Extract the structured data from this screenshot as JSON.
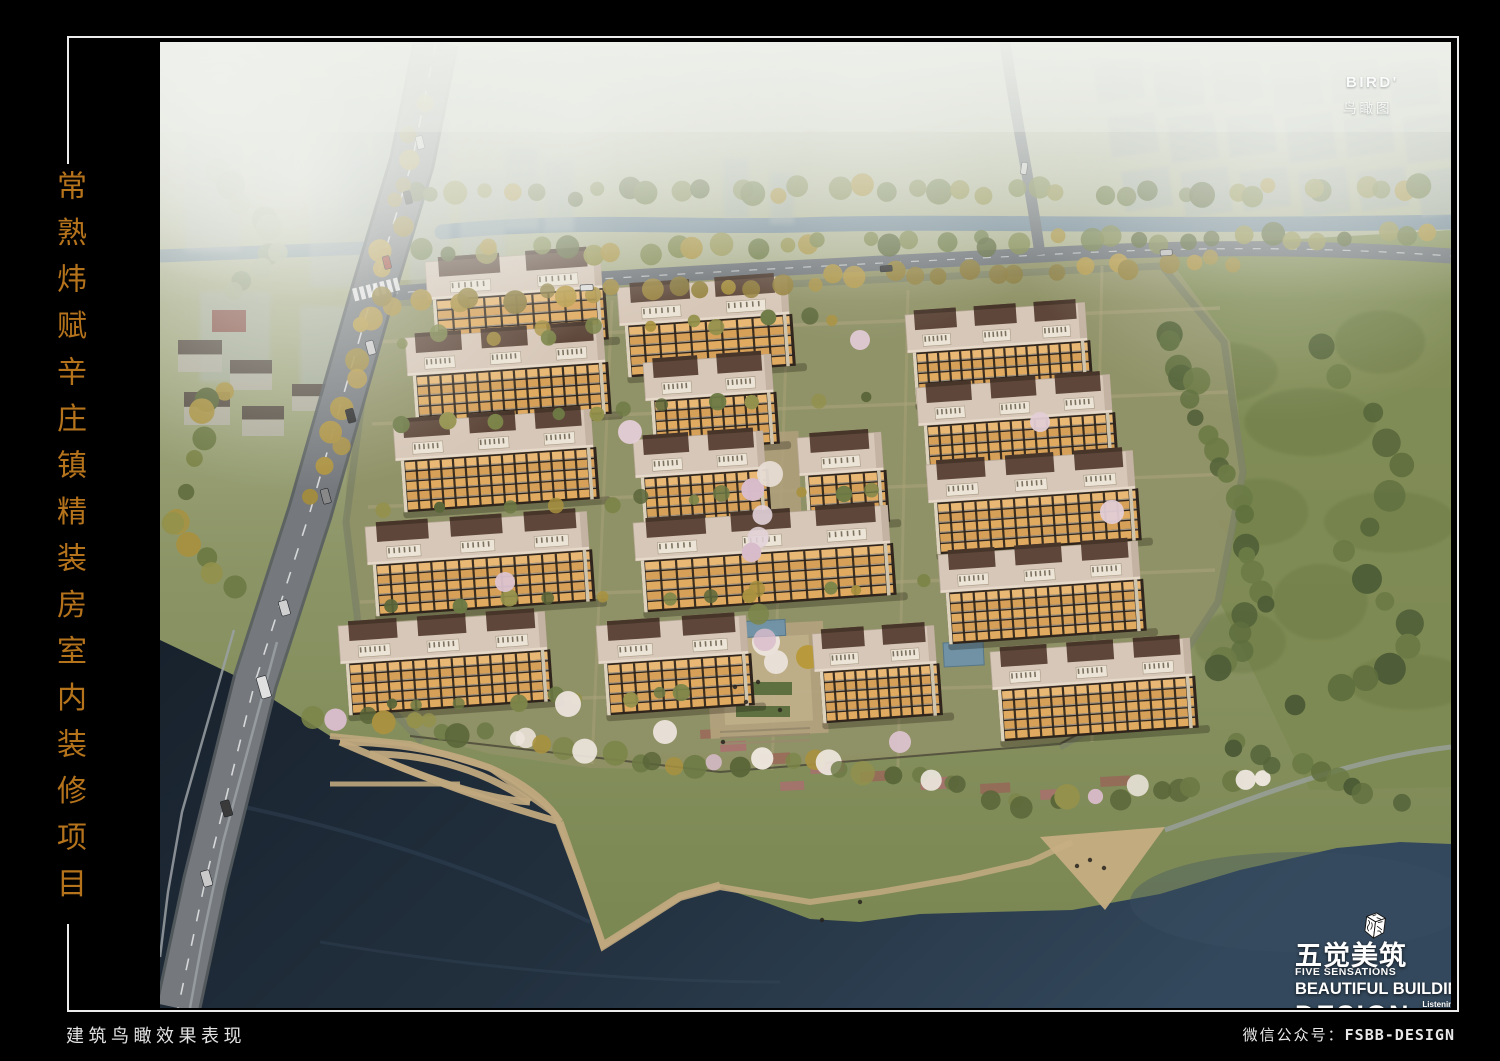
{
  "side_title": {
    "text": "常熟炜赋辛庄镇精装房室内装修项目",
    "color": "#b5731c"
  },
  "artwork": {
    "bird_label": "BIRD'",
    "bird_sublabel": "鸟瞰图"
  },
  "logo": {
    "cn_name": "五觉美筑",
    "en_name": "FIVE SENSATIONS",
    "line1": "BEAUTIFUL BUILDING",
    "line2": "DESIGN",
    "tags": [
      "Listening\\Smelling",
      "Visioning\\Touching",
      "Tasting\\Performance"
    ]
  },
  "footer": {
    "left_caption": "建筑鸟瞰效果表现",
    "right_label": "微信公众号：",
    "right_code": "FSBB-DESIGN"
  },
  "scene": {
    "w": 1291,
    "h": 966,
    "colors": {
      "field": "#7d8a52",
      "compound": "#8f9166",
      "canal": "#6f8699",
      "road_major": "#75797d",
      "road_minor": "#6d7277",
      "path": "#c0a87e",
      "plaza": "#c7ad83",
      "roof": "#d7c7b8",
      "ridge": "#5e473a",
      "roofbox": "#ece4d6",
      "facade_dark": "#2f251c"
    },
    "palettes": {
      "mix": [
        "#6d7a45",
        "#7c8549",
        "#93914c",
        "#a8913f",
        "#5a6639"
      ],
      "gold": [
        "#ab9140",
        "#b89a45",
        "#93803a",
        "#a38c3e",
        "#8a7a3c"
      ],
      "green": [
        "#5f6f3e",
        "#55643a",
        "#6c7b46",
        "#4d5c36"
      ],
      "shore": [
        "#6d7a45",
        "#7c8549",
        "#a8913f",
        "#5a6639",
        "#93914c",
        "#6d7a45",
        "#d9bccb",
        "#ece5dc"
      ],
      "pinkmix": [
        "#d9bccb",
        "#e3d3da",
        "#a8913f",
        "#7c8549"
      ],
      "fade": [
        "#8f9a78",
        "#9aa382",
        "#a5ad8c"
      ]
    },
    "paths": {
      "field": "M 1000,205 L 1291,188 L 1291,745 L 1150,748 L 1060,560 L 1085,430 L 1070,300 Z",
      "compound": "M 200,240 L 1000,205 L 1070,300 L 1085,430 L 1060,560 L 1000,648 L 900,700 L 720,718 L 560,728 L 430,726 L 330,712 L 250,690 L 205,640 L 185,480 L 190,350 Z",
      "inner_ring": "M 215,262 L 1002,224 L 1064,300 L 1083,430 L 1058,560 L 1002,646 L 900,705 M 215,262 L 186,480 L 205,640 L 262,700",
      "row_paths": [
        "M 215,300 L 1060,266",
        "M 212,382 L 1068,350",
        "M 208,465 L 1070,432",
        "M 200,560 L 1055,528",
        "M 205,662 L 1000,640"
      ],
      "col_paths": [
        "M 452,258 L 432,722",
        "M 628,252 L 612,728",
        "M 748,248 L 738,725",
        "M 942,224 L 932,700"
      ],
      "canal": "M 282,190 C 420,176 520,186 640,183 C 800,178 980,186 1291,180",
      "canal_left": "M 0,214 L 206,206",
      "north_road": "M 212,253 C 420,236 700,222 880,213 C 1050,203 1180,206 1291,214",
      "east_road": "M 845,0 C 856,80 872,150 880,213",
      "west_road": "M 276,0 L 252,120 L 212,253 L 150,470 L 95,640 L 45,840 L 18,966",
      "bridge_edge1": "M 117,600 L 63,800 L 42,900 L 30,966",
      "bridge_edge2": "M 74,588 L 22,770 L 8,850 L 0,915",
      "water": "M 0,598 L 80,636 L 170,694 L 250,702 L 330,726 L 395,772 L 428,860 L 443,905 L 470,888 L 520,856 L 560,845 L 610,862 L 650,877 L 700,880 L 760,872 L 830,870 L 912,868 L 1000,852 L 1080,828 L 1177,806 L 1240,800 L 1291,802 L 1291,966 L 0,966 Z",
      "shoreline": "M 170,694 L 250,702 L 330,726 L 395,772 L 428,860 L 443,905 L 470,888 L 520,856 L 560,845 L 650,860 L 720,850 L 800,836 L 870,820 L 912,800",
      "leaf1a": "M 180,700 Q 260,700 330,726 Q 380,748 400,780",
      "leaf1b": "M 180,700 Q 300,752 400,780",
      "leaf2a": "M 210,712 Q 300,712 370,760",
      "leaf2b": "M 210,712 Q 310,756 370,760",
      "pier": "M 170,742 L 300,742",
      "walk": "M 400,780 L 428,860 L 443,903 L 470,886 L 520,854 L 560,843",
      "plaza_tri": "M 880,795 L 1005,785 L 945,868 Z",
      "right_path": "M 1005,788 C 1080,762 1180,718 1291,705",
      "fence": "M 250,694 L 560,730 L 900,702 L 1000,648",
      "water_hl1": "M 60,760 Q 260,800 430,880",
      "water_hl2": "M 160,900 Q 400,940 620,940"
    },
    "buildings": [
      {
        "x": 265,
        "y": 220,
        "w": 175,
        "u": 2
      },
      {
        "x": 245,
        "y": 296,
        "w": 198,
        "u": 3
      },
      {
        "x": 233,
        "y": 381,
        "w": 198,
        "u": 3
      },
      {
        "x": 205,
        "y": 485,
        "w": 222,
        "u": 3
      },
      {
        "x": 178,
        "y": 584,
        "w": 207,
        "u": 3
      },
      {
        "x": 457,
        "y": 246,
        "w": 170,
        "u": 2
      },
      {
        "x": 483,
        "y": 321,
        "w": 128,
        "u": 2
      },
      {
        "x": 473,
        "y": 398,
        "w": 130,
        "u": 2
      },
      {
        "x": 637,
        "y": 396,
        "w": 84,
        "u": 1
      },
      {
        "x": 473,
        "y": 481,
        "w": 255,
        "u": 3
      },
      {
        "x": 436,
        "y": 584,
        "w": 150,
        "u": 2
      },
      {
        "x": 652,
        "y": 592,
        "w": 122,
        "u": 2
      },
      {
        "x": 745,
        "y": 273,
        "w": 180,
        "u": 3
      },
      {
        "x": 756,
        "y": 346,
        "w": 194,
        "u": 3
      },
      {
        "x": 766,
        "y": 423,
        "w": 207,
        "u": 3
      },
      {
        "x": 778,
        "y": 513,
        "w": 200,
        "u": 3
      },
      {
        "x": 830,
        "y": 610,
        "w": 200,
        "u": 3
      }
    ],
    "bands": [
      {
        "pts": [
          [
            240,
            156
          ],
          [
            600,
            148
          ],
          [
            1000,
            150
          ],
          [
            1291,
            148
          ]
        ],
        "n": 40,
        "r": [
          7,
          13
        ],
        "pal": "mix"
      },
      {
        "pts": [
          [
            252,
            212
          ],
          [
            600,
            204
          ],
          [
            900,
            198
          ],
          [
            1291,
            194
          ]
        ],
        "n": 38,
        "r": [
          7,
          12
        ],
        "pal": "mix"
      },
      {
        "pts": [
          [
            224,
            260
          ],
          [
            560,
            245
          ],
          [
            880,
            225
          ],
          [
            1100,
            220
          ]
        ],
        "n": 32,
        "r": [
          7,
          12
        ],
        "pal": "gold"
      },
      {
        "pts": [
          [
            264,
            58
          ],
          [
            242,
            158
          ],
          [
            216,
            254
          ],
          [
            182,
            378
          ],
          [
            152,
            468
          ]
        ],
        "n": 18,
        "r": [
          7,
          12
        ],
        "pal": "gold"
      },
      {
        "pts": [
          [
            64,
            328
          ],
          [
            34,
            418
          ],
          [
            14,
            498
          ],
          [
            90,
            555
          ]
        ],
        "n": 12,
        "r": [
          8,
          13
        ],
        "pal": "mix"
      },
      {
        "pts": [
          [
            1004,
            280
          ],
          [
            1042,
            380
          ],
          [
            1082,
            480
          ],
          [
            1098,
            560
          ],
          [
            1058,
            640
          ]
        ],
        "n": 24,
        "r": [
          8,
          14
        ],
        "pal": "green"
      },
      {
        "pts": [
          [
            1150,
            300
          ],
          [
            1250,
            420
          ],
          [
            1180,
            520
          ],
          [
            1268,
            600
          ],
          [
            1120,
            680
          ]
        ],
        "n": 16,
        "r": [
          9,
          16
        ],
        "pal": "green"
      },
      {
        "pts": [
          [
            150,
            670
          ],
          [
            300,
            688
          ],
          [
            420,
            708
          ],
          [
            520,
            728
          ],
          [
            640,
            716
          ],
          [
            760,
            736
          ],
          [
            880,
            766
          ],
          [
            1000,
            744
          ],
          [
            1120,
            736
          ]
        ],
        "n": 46,
        "r": [
          7,
          13
        ],
        "pal": "shore"
      },
      {
        "pts": [
          [
            1060,
            700
          ],
          [
            1160,
            730
          ],
          [
            1240,
            760
          ]
        ],
        "n": 10,
        "r": [
          8,
          13
        ],
        "pal": "green"
      },
      {
        "pts": [
          [
            240,
            296
          ],
          [
            700,
            278
          ]
        ],
        "n": 12,
        "r": [
          5,
          9
        ],
        "pal": "mix"
      },
      {
        "pts": [
          [
            235,
            378
          ],
          [
            720,
            358
          ]
        ],
        "n": 11,
        "r": [
          5,
          9
        ],
        "pal": "mix"
      },
      {
        "pts": [
          [
            222,
            468
          ],
          [
            760,
            448
          ]
        ],
        "n": 11,
        "r": [
          5,
          9
        ],
        "pal": "mix"
      },
      {
        "pts": [
          [
            212,
            562
          ],
          [
            800,
            542
          ]
        ],
        "n": 11,
        "r": [
          5,
          9
        ],
        "pal": "mix"
      },
      {
        "pts": [
          [
            205,
            658
          ],
          [
            560,
            655
          ]
        ],
        "n": 9,
        "r": [
          5,
          9
        ],
        "pal": "mix"
      },
      {
        "pts": [
          [
            592,
            428
          ],
          [
            600,
            520
          ],
          [
            606,
            622
          ]
        ],
        "n": 7,
        "r": [
          8,
          12
        ],
        "pal": "pinkmix"
      },
      {
        "pts": [
          [
            60,
            130
          ],
          [
            120,
            200
          ],
          [
            60,
            260
          ]
        ],
        "n": 10,
        "r": [
          9,
          15
        ],
        "pal": "fade"
      }
    ],
    "blossoms": [
      [
        610,
        432,
        13,
        "#e7dcd4"
      ],
      [
        616,
        620,
        12,
        "#eae2da"
      ],
      [
        470,
        390,
        12,
        "#e3cdd6"
      ],
      [
        505,
        690,
        12,
        "#ece4dc"
      ],
      [
        740,
        700,
        11,
        "#dcc3cf"
      ],
      [
        952,
        470,
        12,
        "#e3cdd6"
      ],
      [
        700,
        298,
        10,
        "#dfc9d3"
      ],
      [
        408,
        662,
        13,
        "#ece4dc"
      ],
      [
        345,
        540,
        10,
        "#dcc3cf"
      ],
      [
        880,
        380,
        10,
        "#e3cdd6"
      ]
    ],
    "city_left": [
      [
        25,
        95,
        55,
        115
      ],
      [
        95,
        55,
        45,
        95
      ],
      [
        150,
        115,
        65,
        130
      ],
      [
        250,
        80,
        40,
        170
      ],
      [
        300,
        130,
        45,
        110
      ],
      [
        40,
        250,
        70,
        90
      ],
      [
        140,
        265,
        60,
        85
      ]
    ],
    "mid_towers": [
      [
        180,
        55,
        28,
        120
      ],
      [
        213,
        68,
        24,
        107
      ],
      [
        345,
        106,
        34,
        82
      ],
      [
        384,
        118,
        30,
        72
      ],
      [
        563,
        116,
        26,
        60
      ],
      [
        610,
        130,
        24,
        52
      ]
    ],
    "city_right": {
      "rows": [
        22,
        76,
        130
      ],
      "x0": 933,
      "dx": 59,
      "n": 6,
      "w": 48,
      "h": 40
    },
    "houses": [
      [
        18,
        298,
        44,
        32
      ],
      [
        70,
        318,
        42,
        30
      ],
      [
        24,
        350,
        46,
        33
      ],
      [
        82,
        364,
        42,
        30
      ],
      [
        132,
        342,
        38,
        27
      ]
    ],
    "shop": [
      52,
      268,
      34,
      22
    ],
    "field_blobs": [
      [
        1060,
        330
      ],
      [
        1150,
        380
      ],
      [
        1220,
        300
      ],
      [
        1100,
        470
      ],
      [
        1230,
        480
      ],
      [
        1160,
        560
      ],
      [
        1250,
        640
      ],
      [
        1080,
        600
      ]
    ],
    "pools": [
      [
        575,
        580,
        50,
        16
      ],
      [
        783,
        601,
        40,
        24
      ]
    ],
    "garden_plaza": {
      "x": 545,
      "y": 585,
      "w": 118,
      "h": 112
    },
    "flowerbeds": [
      [
        560,
        700,
        26,
        10
      ],
      [
        600,
        712,
        30,
        11
      ],
      [
        650,
        720,
        34,
        12
      ],
      [
        700,
        730,
        30,
        10
      ],
      [
        760,
        736,
        34,
        12
      ],
      [
        820,
        742,
        30,
        10
      ],
      [
        880,
        748,
        26,
        10
      ],
      [
        940,
        735,
        30,
        10
      ],
      [
        620,
        740,
        24,
        9
      ],
      [
        540,
        688,
        22,
        9
      ]
    ],
    "cars": [
      {
        "x": 255,
        "y": 95,
        "w": 7,
        "h": 13,
        "c": "#d8d8d8",
        "r": -14
      },
      {
        "x": 243,
        "y": 150,
        "w": 7,
        "h": 13,
        "c": "#303030",
        "r": -14
      },
      {
        "x": 222,
        "y": 215,
        "w": 7,
        "h": 13,
        "c": "#9a3b2e",
        "r": -14
      },
      {
        "x": 205,
        "y": 300,
        "w": 8,
        "h": 14,
        "c": "#cccccc",
        "r": -15
      },
      {
        "x": 185,
        "y": 368,
        "w": 8,
        "h": 14,
        "c": "#2b2b2b",
        "r": -15
      },
      {
        "x": 160,
        "y": 448,
        "w": 8,
        "h": 15,
        "c": "#888888",
        "r": -15
      },
      {
        "x": 118,
        "y": 560,
        "w": 9,
        "h": 15,
        "c": "#d0d0d0",
        "r": -16
      },
      {
        "x": 96,
        "y": 636,
        "w": 10,
        "h": 22,
        "c": "#e0e0e0",
        "r": -16
      },
      {
        "x": 60,
        "y": 760,
        "w": 9,
        "h": 16,
        "c": "#3a3a3a",
        "r": -16
      },
      {
        "x": 40,
        "y": 830,
        "w": 9,
        "h": 16,
        "c": "#c9c9c9",
        "r": -16
      },
      {
        "x": 420,
        "y": 243,
        "w": 13,
        "h": 6,
        "c": "#dddddd",
        "r": -3
      },
      {
        "x": 720,
        "y": 224,
        "w": 12,
        "h": 6,
        "c": "#333333",
        "r": -4
      },
      {
        "x": 1000,
        "y": 208,
        "w": 12,
        "h": 6,
        "c": "#bbbbbb",
        "r": -4
      },
      {
        "x": 862,
        "y": 120,
        "w": 6,
        "h": 12,
        "c": "#cfcfcf",
        "r": 8
      }
    ],
    "people": [
      [
        598,
        640
      ],
      [
        586,
        660
      ],
      [
        620,
        668
      ],
      [
        563,
        700
      ],
      [
        930,
        818
      ],
      [
        944,
        826
      ],
      [
        917,
        824
      ],
      [
        700,
        860
      ],
      [
        662,
        878
      ],
      [
        575,
        645
      ]
    ]
  }
}
